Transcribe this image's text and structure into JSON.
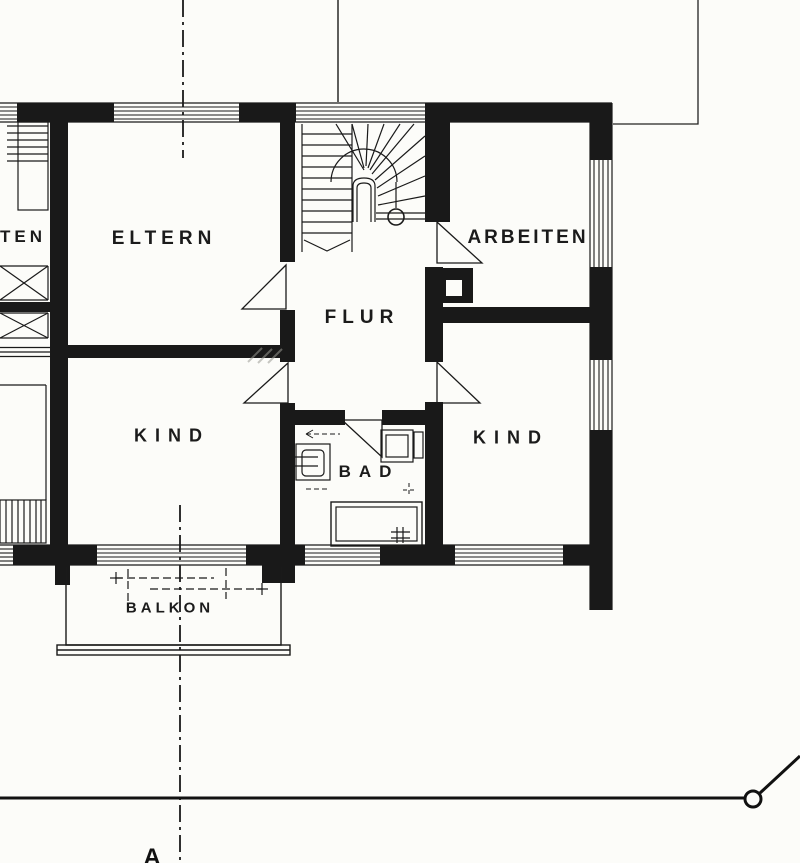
{
  "title": "upper-floor-plan",
  "colors": {
    "ink": "#1a1a1a",
    "paper": "#fcfcf9"
  },
  "rooms": [
    {
      "id": "eltern",
      "label": "ELTERN"
    },
    {
      "id": "arbeiten",
      "label": "ARBEITEN"
    },
    {
      "id": "flur",
      "label": "FLUR"
    },
    {
      "id": "kind-left",
      "label": "KIND"
    },
    {
      "id": "kind-right",
      "label": "KIND"
    },
    {
      "id": "bad",
      "label": "BAD"
    },
    {
      "id": "balkon",
      "label": "BALKON"
    },
    {
      "id": "neighbor-partial",
      "label": "TEN"
    }
  ],
  "section": {
    "label": "A"
  },
  "symbols": {
    "staircase": "winder-staircase",
    "chimney": "chimney-flue",
    "toilet": "wc",
    "washbasin": "washbasin",
    "bathtub": "bathtub-with-drain",
    "balcony_railing": "balcony-railing",
    "survey_marker": "terrain-line-with-circle-marker",
    "section_line": "dash-dot-section-line"
  }
}
